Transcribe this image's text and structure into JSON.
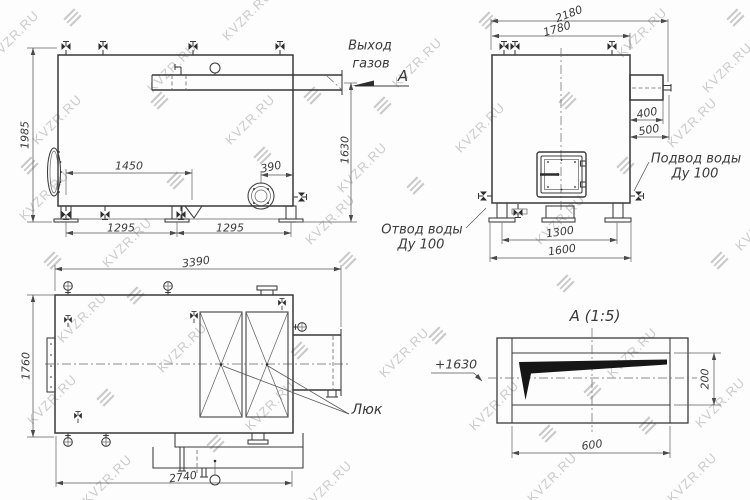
{
  "watermark": {
    "text": "KVZR.RU",
    "color": "#cbcbcb"
  },
  "colors": {
    "line": "#3a3a3a",
    "background": "#fdfdfd"
  },
  "side_view": {
    "height": "1985",
    "pitch": "1450",
    "flange_offset": "390",
    "outlet_height": "1630",
    "span_left": "1295",
    "span_right": "1295",
    "gas_outlet_line1": "Выход",
    "gas_outlet_line2": "газов",
    "section_letter": "А"
  },
  "front_view": {
    "width_overall": "2180",
    "width_body": "1780",
    "duct_length": "400",
    "duct_overall": "500",
    "base_inner": "1300",
    "base_outer": "1600",
    "water_inlet_line1": "Подвод воды",
    "water_inlet_line2": "Ду 100",
    "water_outlet_line1": "Отвод воды",
    "water_outlet_line2": "Ду 100"
  },
  "top_view": {
    "length_overall": "3390",
    "width_overall": "1760",
    "base_length": "2740",
    "hatch_label": "Люк"
  },
  "detail_view": {
    "title": "А (1:5)",
    "level_mark": "+1630",
    "height": "200",
    "width": "600"
  }
}
